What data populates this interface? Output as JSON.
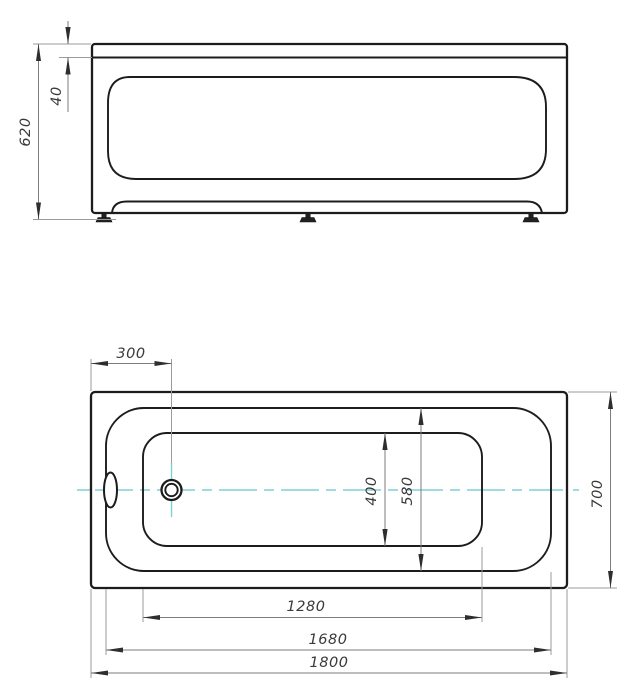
{
  "colors": {
    "outline": "#1c1c1c",
    "dimension_line": "#7d7d7d",
    "extension_line": "#9b9b9b",
    "label_text": "#3a3a3a",
    "centerline": "#7fd0d5",
    "background": "#ffffff"
  },
  "front_view": {
    "dim_total_height": "620",
    "dim_rim_height": "40"
  },
  "plan_view": {
    "dim_drain_offset": "300",
    "dim_bottom_length": "1280",
    "dim_rim_length": "1680",
    "dim_total_length": "1800",
    "dim_bottom_width": "400",
    "dim_rim_width": "580",
    "dim_total_width": "700"
  }
}
